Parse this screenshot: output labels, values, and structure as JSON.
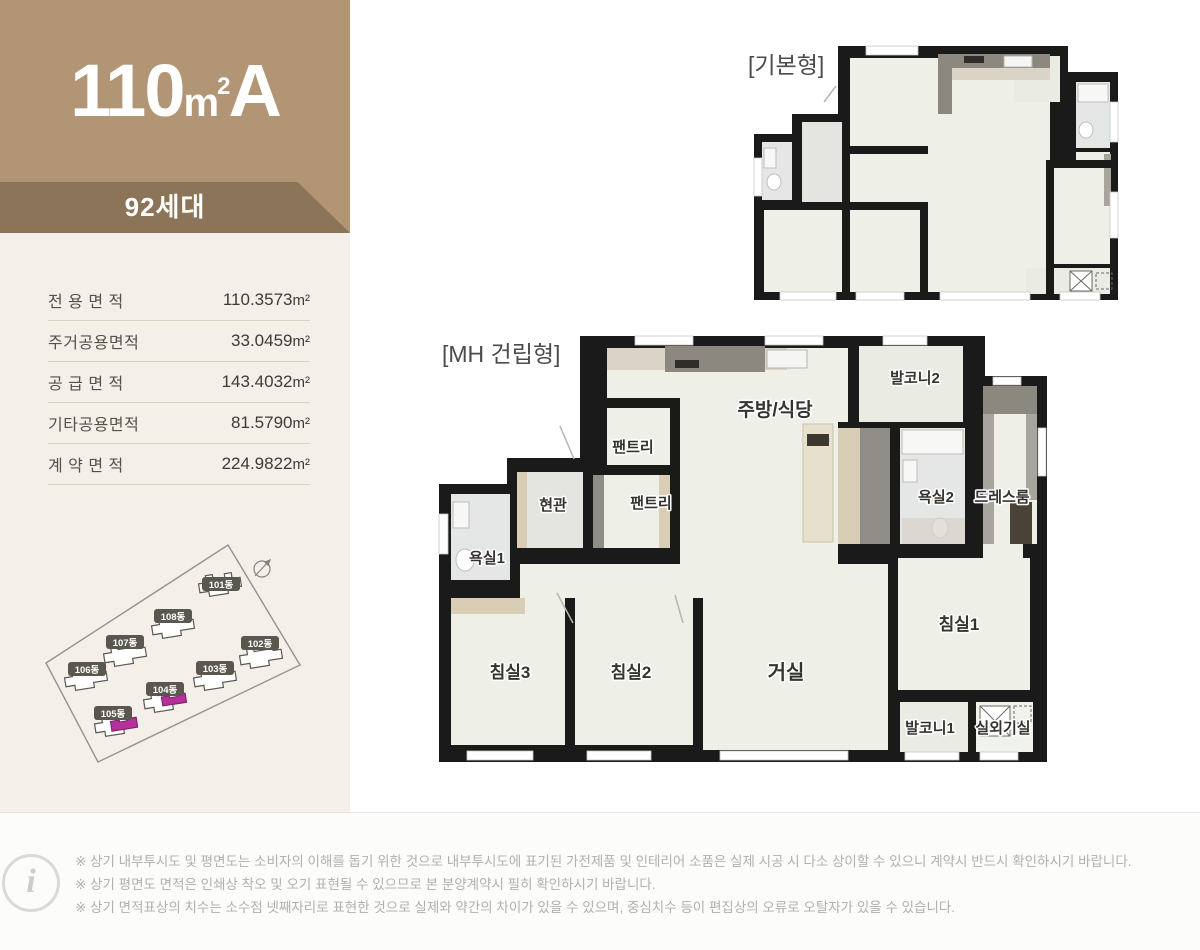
{
  "unit": {
    "size": "110",
    "unit_base": "m",
    "unit_exp": "2",
    "type_letter": "A",
    "households": "92세대"
  },
  "area_table": {
    "rows": [
      {
        "label": "전 용 면 적",
        "value": "110.3573",
        "unit": "m²"
      },
      {
        "label": "주거공용면적",
        "value": "33.0459",
        "unit": "m²"
      },
      {
        "label": "공 급 면 적",
        "value": "143.4032",
        "unit": "m²"
      },
      {
        "label": "기타공용면적",
        "value": "81.5790",
        "unit": "m²"
      },
      {
        "label": "계 약 면 적",
        "value": "224.9822",
        "unit": "m²"
      }
    ]
  },
  "site_plan": {
    "compass_icon": "compass-north-icon",
    "highlight_color": "#b5309b",
    "buildings": [
      {
        "label": "101동",
        "highlighted": false
      },
      {
        "label": "108동",
        "highlighted": false
      },
      {
        "label": "107동",
        "highlighted": false
      },
      {
        "label": "106동",
        "highlighted": false
      },
      {
        "label": "102동",
        "highlighted": false
      },
      {
        "label": "103동",
        "highlighted": false
      },
      {
        "label": "104동",
        "highlighted": true
      },
      {
        "label": "105동",
        "highlighted": true
      }
    ]
  },
  "plans": {
    "basic": {
      "label": "[기본형]"
    },
    "mh": {
      "label": "[MH 건립형]",
      "rooms": [
        {
          "name": "발코니2"
        },
        {
          "name": "주방/식당"
        },
        {
          "name": "팬트리"
        },
        {
          "name": "팬트리"
        },
        {
          "name": "현관"
        },
        {
          "name": "욕실1"
        },
        {
          "name": "욕실2"
        },
        {
          "name": "드레스룸"
        },
        {
          "name": "침실3"
        },
        {
          "name": "침실2"
        },
        {
          "name": "거실"
        },
        {
          "name": "침실1"
        },
        {
          "name": "발코니1"
        },
        {
          "name": "실외기실"
        }
      ]
    }
  },
  "footer": {
    "info_icon_glyph": "i",
    "notes": [
      "※ 상기 내부투시도 및 평면도는 소비자의 이해를 돕기 위한 것으로 내부투시도에 표기된 가전제품 및 인테리어 소품은 실제 시공 시 다소 상이할 수 있으니 계약시 반드시 확인하시기 바랍니다.",
      "※ 상기 평면도 면적은 인쇄상 착오 및 오기 표현될 수 있으므로 본 분양계약시 필히 확인하시기 바랍니다.",
      "※ 상기 면적표상의 치수는 소수점 넷째자리로 표현한 것으로 실제와 약간의 차이가 있을 수 있으며, 중심치수 등이 편집상의 오류로 오탈자가 있을 수 있습니다."
    ]
  },
  "colors": {
    "header_tan": "#b19574",
    "band_brown": "#8c7458",
    "sidebar_bg": "#f4f0e9",
    "wall_black": "#1a1a1a",
    "floor_cream": "#eef0e7",
    "highlight_magenta": "#b5309b"
  }
}
